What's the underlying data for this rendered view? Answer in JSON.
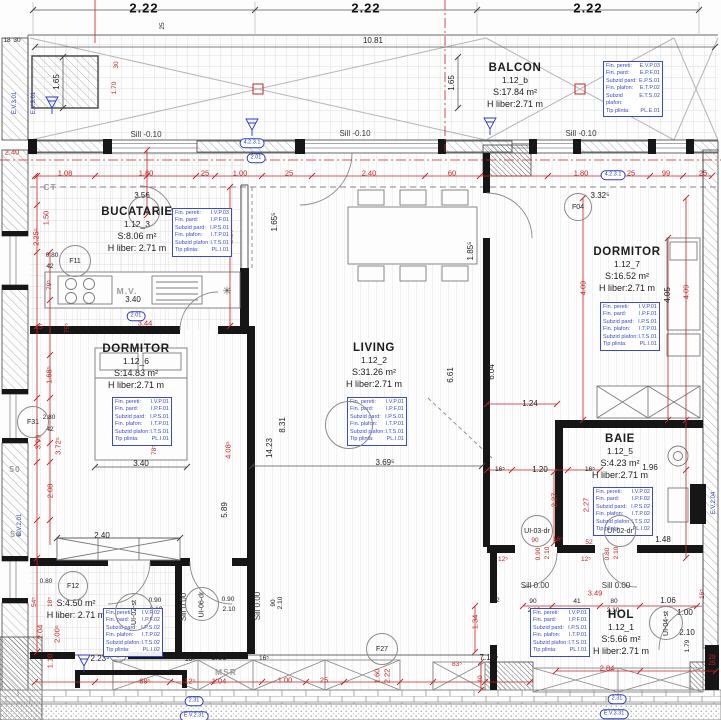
{
  "colors": {
    "accent_red": "#c22525",
    "annotation_blue": "#2b3bbd",
    "wall_black": "#161616"
  },
  "finish_labels": [
    "Fin. pereti:",
    "Fin. pard:",
    "Subzid pard:",
    "Fin. plafon:",
    "Subzid plafon:",
    "Tip plinta:"
  ],
  "rooms": [
    {
      "key": "balcon",
      "name": "BALCON",
      "id": "1.12_b",
      "area": "S:17.84 m²",
      "h": "H liber:2.71 m",
      "cx": 515,
      "cy": 62,
      "finish": {
        "x": 603,
        "y": 61,
        "codes": [
          "E.V.P.03",
          "E.P.F.01",
          "E.P.S.01",
          "E.T.P.02",
          "E.T.S.02",
          "PL.E.01"
        ]
      }
    },
    {
      "key": "bucatarie",
      "name": "BUCATARIE",
      "id": "1.12_3",
      "area": "S:8.06 m²",
      "h": "H liber: 2.71 m",
      "cx": 137,
      "cy": 206,
      "finish": {
        "x": 172,
        "y": 208,
        "codes": [
          "I.V.P.03",
          "I.P.F.01",
          "I.P.S.01",
          "I.T.P.01",
          "I.T.S.01",
          "PL.I.01"
        ]
      }
    },
    {
      "key": "dormitor-left",
      "name": "DORMITOR",
      "id": "1.12_6",
      "area": "S:14.83 m²",
      "h": "H liber:2.71 m",
      "cx": 136,
      "c***y": 0,
      "cy": 343,
      "finish": {
        "x": 112,
        "y": 397,
        "codes": [
          "I.V.P.01",
          "I.P.F.01",
          "I.P.S.01",
          "I.T.P.01",
          "I.T.S.01",
          "PL.I.01"
        ]
      }
    },
    {
      "key": "living",
      "name": "LIVING",
      "id": "1.12_2",
      "area": "S:31.26 m²",
      "h": "H liber:2.71 m",
      "cx": 374,
      "cy": 342,
      "finish": {
        "x": 347,
        "y": 397,
        "codes": [
          "I.V.P.01",
          "I.P.F.01",
          "I.P.S.01",
          "I.T.P.01",
          "I.T.S.01",
          "PL.I.01"
        ]
      }
    },
    {
      "key": "dormitor-right",
      "name": "DORMITOR",
      "id": "1.12_7",
      "area": "S:16.52 m²",
      "h": "H liber:2.71 m",
      "cx": 627,
      "cy": 246,
      "finish": {
        "x": 600,
        "y": 302,
        "codes": [
          "I.V.P.01",
          "I.P.F.01",
          "I.P.S.01",
          "I.T.P.01",
          "I.T.S.01",
          "PL.I.01"
        ]
      }
    },
    {
      "key": "baie",
      "name": "BAIE",
      "id": "1.12_5",
      "area": "S:4.23 m²",
      "h": "H liber:2.71 m",
      "cx": 620,
      "cy": 433,
      "finish": {
        "x": 593,
        "y": 487,
        "codes": [
          "I.V.P.02",
          "I.P.F.02",
          "I.P.S.02",
          "I.T.P.02",
          "I.T.S.02",
          "PL.I.02"
        ]
      }
    },
    {
      "key": "hol",
      "name": "HOL",
      "id": "1.12_1",
      "area": "S:5.66 m²",
      "h": "H liber:2.71 m",
      "cx": 621,
      "cy": 609,
      "finish": {
        "x": 530,
        "y": 608,
        "codes": [
          "I.V.P.01",
          "I.P.F.01",
          "I.P.S.01",
          "I.T.P.01",
          "I.T.S.01",
          "PL.I.01"
        ]
      }
    },
    {
      "key": "baie-2",
      "name": null,
      "id": null,
      "area": "S:4.50 m²",
      "h": "H liber: 2.71 m",
      "cx": 76,
      "cy": 596,
      "finish": {
        "x": 103,
        "y": 608,
        "codes": [
          "I.V.P.02",
          "I.P.F.02",
          "I.P.S.02",
          "I.T.P.02",
          "I.T.S.02",
          "PL.I.02"
        ]
      }
    }
  ],
  "circles": [
    {
      "t": "F11",
      "x": 75,
      "y": 261,
      "r": 16
    },
    {
      "t": "F31",
      "x": 33,
      "y": 422,
      "r": 16
    },
    {
      "t": "F04",
      "x": 578,
      "y": 207,
      "r": 14
    },
    {
      "t": "F12",
      "x": 73,
      "y": 586,
      "r": 15
    },
    {
      "t": "F27",
      "x": 382,
      "y": 649,
      "r": 16
    },
    {
      "t": "UI-02-st",
      "x": 134,
      "y": 612,
      "r": 19,
      "rot": 1
    },
    {
      "t": "UI-06-dr",
      "x": 202,
      "y": 604,
      "r": 17,
      "rot": 1
    },
    {
      "t": "UI-03-dr",
      "x": 537,
      "y": 531,
      "r": 16
    },
    {
      "t": "UI-02-dr",
      "x": 620,
      "y": 531,
      "r": 16
    },
    {
      "t": "UI-04-st",
      "x": 666,
      "y": 623,
      "r": 17,
      "rot": 1
    },
    {
      "t": "",
      "x": 144,
      "y": 212,
      "r": 16
    },
    {
      "t": "",
      "x": 349,
      "y": 425,
      "r": 24
    }
  ],
  "pills": [
    {
      "t": "4.2.3.1",
      "x": 252,
      "y": 143
    },
    {
      "t": "2.01",
      "x": 256,
      "y": 158
    },
    {
      "t": "2.01",
      "x": 136,
      "y": 316
    },
    {
      "t": "4.2.3.1",
      "x": 613,
      "y": 175
    },
    {
      "t": "2.31",
      "x": 194,
      "y": 701
    },
    {
      "t": "E.V.2.31",
      "x": 194,
      "y": 716
    },
    {
      "t": "2.31",
      "x": 617,
      "y": 699
    },
    {
      "t": "E.V.3.31",
      "x": 614,
      "y": 714
    }
  ],
  "labels": [
    [
      "2.22",
      144,
      8,
      "t"
    ],
    [
      "2.22",
      366,
      8,
      "t"
    ],
    [
      "2.22",
      588,
      8,
      "t"
    ],
    [
      "10.81",
      373,
      41,
      "k"
    ],
    [
      "1.65",
      57,
      82,
      "k",
      1
    ],
    [
      "1.65",
      452,
      83,
      "k",
      1
    ],
    [
      "25",
      163,
      26,
      "k6",
      1
    ],
    [
      "18",
      7,
      41,
      "k6"
    ],
    [
      "30",
      17,
      41,
      "k6"
    ],
    [
      "Sill -0.10",
      146,
      135,
      "sill"
    ],
    [
      "Sill -0.10",
      355,
      134,
      "sill"
    ],
    [
      "Sill -0.10",
      581,
      134,
      "sill"
    ],
    [
      "3.56",
      142,
      196,
      "k"
    ],
    [
      "CT",
      50,
      187,
      "g"
    ],
    [
      "M.V.",
      127,
      291,
      "g"
    ],
    [
      "3.40",
      133,
      300,
      "k"
    ],
    [
      "✳",
      227,
      292,
      "sym"
    ],
    [
      "3.44",
      145,
      323,
      "r"
    ],
    [
      "2.29⁵",
      230,
      235,
      "r",
      1
    ],
    [
      "1.65⁵",
      275,
      222,
      "k",
      1
    ],
    [
      "1.85⁵",
      471,
      251,
      "k",
      1
    ],
    [
      "2.40",
      102,
      536,
      "k"
    ],
    [
      "3.40",
      141,
      464,
      "k"
    ],
    [
      "2.40",
      12,
      152,
      "r"
    ],
    [
      "8.31",
      283,
      425,
      "k",
      1
    ],
    [
      "14.23",
      270,
      448,
      "k",
      1
    ],
    [
      "5.89",
      225,
      510,
      "k",
      1
    ],
    [
      "6.61",
      451,
      375,
      "k",
      1
    ],
    [
      "6.04",
      492,
      372,
      "k",
      1
    ],
    [
      "3.69⁵",
      385,
      463,
      "k"
    ],
    [
      "1.24",
      530,
      404,
      "k"
    ],
    [
      "16⁵",
      500,
      470,
      "k6"
    ],
    [
      "1.20",
      540,
      470,
      "k"
    ],
    [
      "16⁵",
      590,
      470,
      "k6"
    ],
    [
      "3.32⁵",
      600,
      196,
      "k"
    ],
    [
      "4.05",
      668,
      295,
      "k",
      1
    ],
    [
      "1.96",
      650,
      468,
      "k"
    ],
    [
      "1.48",
      663,
      540,
      "k"
    ],
    [
      "Sill 0.00",
      535,
      586,
      "sill"
    ],
    [
      "Sill 0.00",
      616,
      586,
      "sill"
    ],
    [
      "Sill 0.00",
      184,
      607,
      "sill",
      1
    ],
    [
      "Sill 0.00",
      258,
      606,
      "sill",
      1
    ],
    [
      "0.90",
      155,
      601,
      "k6"
    ],
    [
      "2.10",
      156,
      610,
      "k6"
    ],
    [
      "0.90",
      228,
      600,
      "k6"
    ],
    [
      "2.10",
      229,
      610,
      "k6"
    ],
    [
      "90",
      274,
      603,
      "k6",
      1
    ],
    [
      "2.10",
      281,
      603,
      "k6",
      1
    ],
    [
      "90",
      533,
      602,
      "k6"
    ],
    [
      "2.10",
      534,
      611,
      "k6"
    ],
    [
      "41",
      577,
      602,
      "k6"
    ],
    [
      "80",
      614,
      602,
      "k6"
    ],
    [
      "2.10",
      613,
      611,
      "k6"
    ],
    [
      "1.06",
      668,
      601,
      "k"
    ],
    [
      "1.00",
      685,
      613,
      "k"
    ],
    [
      "2.10",
      687,
      633,
      "k"
    ],
    [
      "1.79",
      688,
      646,
      "k6",
      1
    ],
    [
      "0.80",
      46,
      582,
      "k6"
    ],
    [
      "2.23⁵",
      100,
      659,
      "k"
    ],
    [
      "16⁵",
      190,
      660,
      "k6"
    ],
    [
      "1.00",
      219,
      658,
      "k"
    ],
    [
      "16⁵",
      264,
      659,
      "k6"
    ],
    [
      "MSR",
      226,
      672,
      "g"
    ],
    [
      "7.18⁵",
      489,
      658,
      "k"
    ],
    [
      "32",
      496,
      601,
      "k6"
    ],
    [
      "0.80",
      52,
      256,
      "k6"
    ],
    [
      "42",
      50,
      267,
      "k6"
    ],
    [
      "2.80",
      49,
      418,
      "k6"
    ],
    [
      "42",
      50,
      430,
      "k6"
    ],
    [
      "2.04",
      40,
      632,
      "r",
      1
    ],
    [
      "2.00⁵",
      57,
      634,
      "r",
      1
    ],
    [
      "1.10",
      50,
      661,
      "r",
      1
    ],
    [
      "54⁵",
      35,
      602,
      "r6",
      1
    ],
    [
      "18⁵",
      51,
      602,
      "r6",
      1
    ],
    [
      "1.08",
      65,
      173,
      "r"
    ],
    [
      "1.80",
      146,
      173,
      "r"
    ],
    [
      "25",
      205,
      173,
      "r"
    ],
    [
      "1.00",
      240,
      173,
      "r"
    ],
    [
      "25",
      289,
      173,
      "r"
    ],
    [
      "2.40",
      369,
      173,
      "r"
    ],
    [
      "60",
      452,
      173,
      "r"
    ],
    [
      "1.80",
      581,
      173,
      "r"
    ],
    [
      "25",
      631,
      173,
      "r"
    ],
    [
      "99",
      666,
      173,
      "r"
    ],
    [
      "25",
      703,
      173,
      "r"
    ],
    [
      "2.25⁵",
      36,
      237,
      "r",
      1
    ],
    [
      "1.50",
      46,
      218,
      "r",
      1
    ],
    [
      "79⁵",
      50,
      285,
      "r6",
      1
    ],
    [
      "25",
      39,
      328,
      "r6"
    ],
    [
      "75⁵",
      68,
      328,
      "r6",
      1
    ],
    [
      "1.68⁵",
      49,
      375,
      "r",
      1
    ],
    [
      "3.99",
      38,
      442,
      "r",
      1
    ],
    [
      "3.72⁵",
      58,
      446,
      "r",
      1
    ],
    [
      "50",
      15,
      469,
      "g"
    ],
    [
      "2.08",
      50,
      491,
      "r",
      1
    ],
    [
      "50",
      16,
      534,
      "g"
    ],
    [
      "78⁵",
      155,
      450,
      "r6",
      1
    ],
    [
      "4.08⁵",
      228,
      450,
      "r",
      1
    ],
    [
      "4.09",
      583,
      288,
      "r",
      1
    ],
    [
      "4.09",
      686,
      292,
      "r",
      1
    ],
    [
      "2.27",
      554,
      500,
      "r",
      1
    ],
    [
      "2.27",
      586,
      505,
      "r",
      1
    ],
    [
      "52",
      589,
      543,
      "r6"
    ],
    [
      "90",
      535,
      541,
      "r6"
    ],
    [
      "16⁵",
      558,
      540,
      "r6"
    ],
    [
      "0.90",
      539,
      554,
      "r6",
      1
    ],
    [
      "2.10",
      548,
      553,
      "r6",
      1
    ],
    [
      "0.80",
      608,
      554,
      "r6",
      1
    ],
    [
      "2.10",
      617,
      553,
      "r6",
      1
    ],
    [
      "12⁵",
      503,
      560,
      "r6"
    ],
    [
      "12⁵",
      586,
      560,
      "r6"
    ],
    [
      "3.49",
      595,
      593,
      "r"
    ],
    [
      "2.84",
      607,
      668,
      "r"
    ],
    [
      "16⁵",
      703,
      594,
      "r6",
      1
    ],
    [
      "29",
      712,
      658,
      "r6"
    ],
    [
      "25",
      712,
      664,
      "r6"
    ],
    [
      "1.34",
      475,
      622,
      "r",
      1
    ],
    [
      "83⁵",
      457,
      665,
      "r6"
    ],
    [
      "40",
      481,
      679,
      "r6",
      1
    ],
    [
      "89⁵",
      145,
      681,
      "r"
    ],
    [
      "12⁵",
      190,
      681,
      "r"
    ],
    [
      "1.04",
      219,
      681,
      "r"
    ],
    [
      "1.00",
      285,
      680,
      "r"
    ],
    [
      "25",
      324,
      680,
      "r"
    ],
    [
      "1.60",
      377,
      676,
      "r",
      1
    ],
    [
      "2.22",
      387,
      676,
      "r",
      1
    ],
    [
      "30",
      117,
      65,
      "r6",
      1
    ],
    [
      "1.70",
      115,
      88,
      "r6",
      1
    ],
    [
      "E.V.3.01",
      15,
      103,
      "b",
      1
    ],
    [
      "E.V.3.01",
      34,
      103,
      "b",
      1
    ],
    [
      "E.V.2.01",
      20,
      525,
      "b",
      1
    ],
    [
      "E.V.2.04",
      714,
      503,
      "b",
      1
    ]
  ]
}
